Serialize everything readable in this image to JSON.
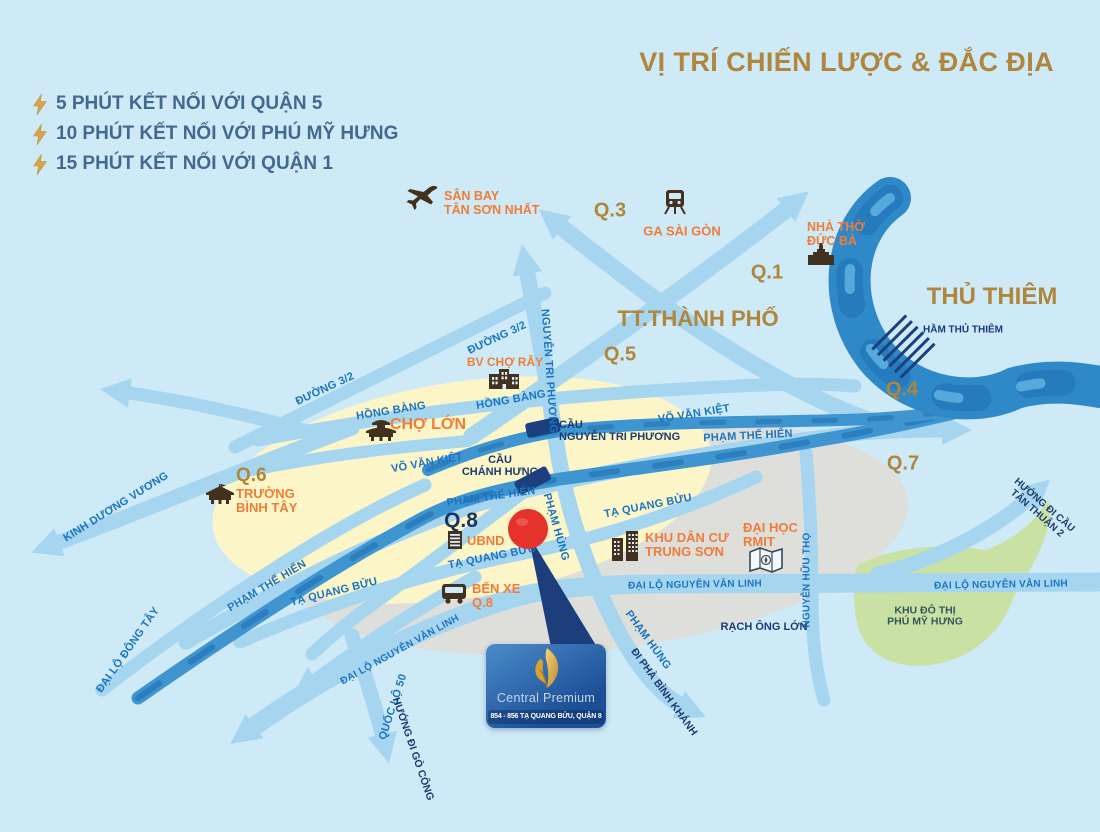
{
  "header": {
    "title": "VỊ TRÍ CHIẾN LƯỢC & ĐẮC ĐỊA",
    "bullets": [
      {
        "text": "5 PHÚT KẾT NỐI VỚI QUẬN 5"
      },
      {
        "text": "10 PHÚT KẾT NỐI VỚI PHÚ MỸ HƯNG"
      },
      {
        "text": "15 PHÚT KẾT NỐI VỚI QUẬN 1"
      }
    ]
  },
  "districts": {
    "q1": "Q.1",
    "q3": "Q.3",
    "q4": "Q.4",
    "q5": "Q.5",
    "q6": "Q.6",
    "q7": "Q.7",
    "q8": "Q.8",
    "city_center": "TT.THÀNH PHỐ",
    "thu_thiem": "THỦ THIÊM"
  },
  "pois": {
    "airport": {
      "line1": "SÂN BAY",
      "line2": "TÂN SƠN NHẤT"
    },
    "train_station": "GA SÀI GÒN",
    "church": {
      "line1": "NHÀ THỜ",
      "line2": "ĐỨC BÀ"
    },
    "hospital": "BV CHỢ RẪY",
    "cho_lon": "CHỢ LỚN",
    "binh_tay_school": {
      "line1": "TRƯỜNG",
      "line2": "BÌNH TÂY"
    },
    "ubnd": "UBND",
    "bus_station": {
      "line1": "BẾN XE",
      "line2": "Q.8"
    },
    "trung_son": {
      "line1": "KHU DÂN CƯ",
      "line2": "TRUNG SƠN"
    },
    "rmit": {
      "line1": "ĐẠI HỌC",
      "line2": "RMIT"
    },
    "phu_my_hung": {
      "line1": "KHU ĐÔ THỊ",
      "line2": "PHÚ MỸ HƯNG"
    }
  },
  "roads": {
    "duong_3_2_a": "ĐƯỜNG 3/2",
    "duong_3_2_b": "ĐƯỜNG 3/2",
    "hong_bang_a": "HỒNG BÀNG",
    "hong_bang_b": "HỒNG BÀNG",
    "nguyen_tri_phuong": "NGUYỄN TRI PHƯƠNG",
    "vo_van_kiet_a": "VÕ VĂN KIỆT",
    "vo_van_kiet_b": "VÕ VĂN KIỆT",
    "pham_the_hien_a": "PHẠM THẾ HIỂN",
    "pham_the_hien_b": "PHẠM THẾ HIỂN",
    "pham_the_hien_c": "PHẠM THẾ HIỂN",
    "ta_quang_buu_a": "TẠ QUANG BỬU",
    "ta_quang_buu_b": "TẠ QUANG BỬU",
    "ta_quang_buu_c": "TẠ QUANG BỬU",
    "pham_hung_a": "PHẠM HÙNG",
    "pham_hung_b": "PHẠM HÙNG",
    "kinh_duong_vuong": "KINH DƯƠNG VƯƠNG",
    "dai_lo_dong_tay": "ĐẠI LỘ ĐÔNG TÂY",
    "nguyen_van_linh_a": "ĐẠI LỘ NGUYỄN VĂN LINH",
    "nguyen_van_linh_b": "ĐẠI LỘ NGUYỄN VĂN LINH",
    "nguyen_van_linh_c": "ĐẠI LỘ NGUYỄN VĂN LINH",
    "quoc_lo_50": "QUỐC LỘ 50",
    "nguyen_huu_tho": "NGUYỄN HỮU THỌ"
  },
  "bridges": {
    "nguyen_tri_phuong": {
      "line1": "CẦU",
      "line2": "NGUYỄN TRI PHƯƠNG"
    },
    "chanh_hung": {
      "line1": "CẦU",
      "line2": "CHÁNH HƯNG"
    }
  },
  "waterways": {
    "rach_ong_lon": "RẠCH ÔNG LỚN",
    "thu_thiem_tunnel": "HẦM THỦ THIÊM"
  },
  "directions": {
    "go_cong": "HƯỚNG ĐI GÒ CÔNG",
    "binh_khanh": "ĐI PHÀ BÌNH KHÁNH",
    "tan_thuan": {
      "line1": "HƯỚNG ĐI CẦU",
      "line2": "TÂN THUẬN 2"
    }
  },
  "project": {
    "name": "Central Premium",
    "address": "854 - 856 TẠ QUANG BỬU, QUẬN 8"
  },
  "colors": {
    "background": "#cfeaf7",
    "road": "#a6d5f0",
    "canal": "#3e95d0",
    "river": "#2f88c8",
    "district_gold": "#b0853c",
    "poi_orange": "#ef7d38",
    "road_label_blue": "#1b74c0",
    "navy": "#1c3c6e",
    "pin_red": "#e5322a",
    "zone_yellow": "#fcf5c8",
    "zone_gray": "#dededb",
    "greenbelt": "#c9e2a4",
    "project_box_blue": "#1c4f96",
    "logo_gold": "#e0a93e"
  }
}
